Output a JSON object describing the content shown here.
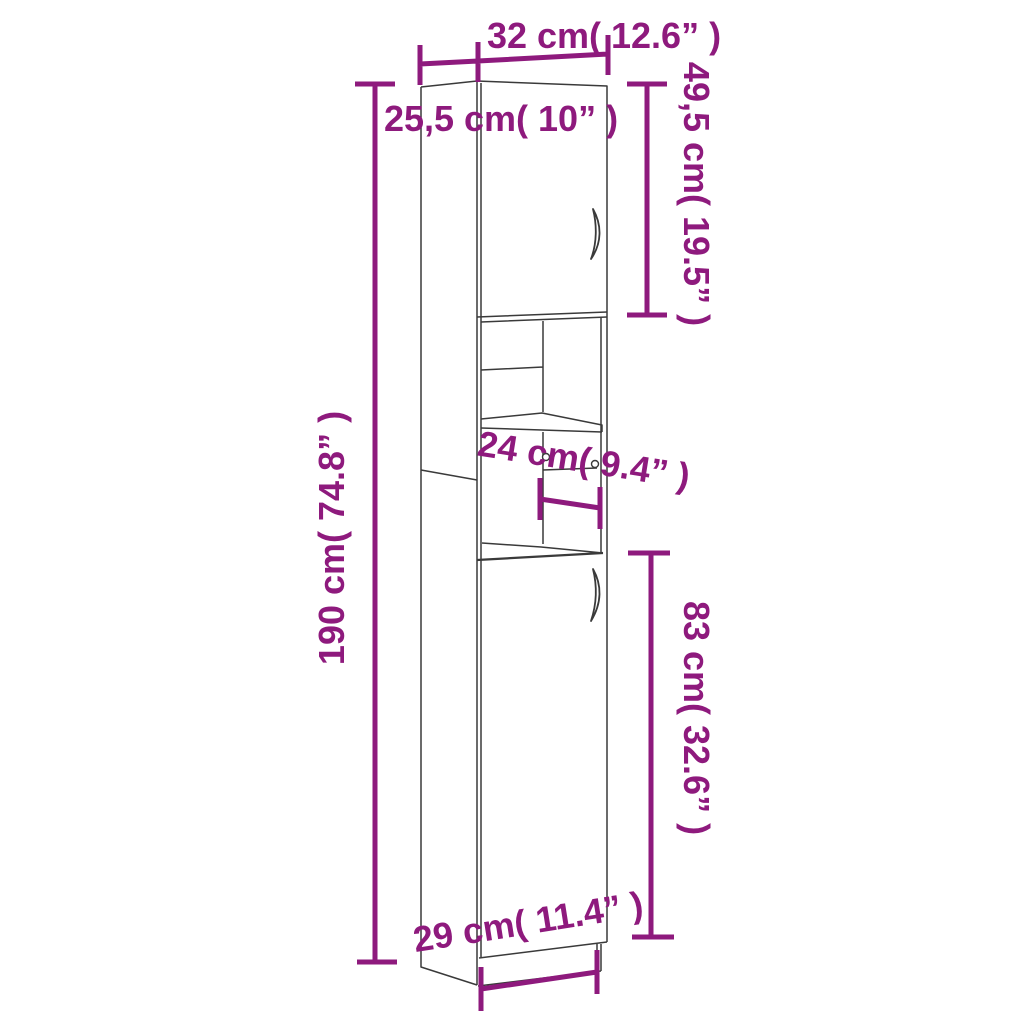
{
  "colors": {
    "background": "#ffffff",
    "accent": "#8e1a7d",
    "drawing_line": "#3a3a3a"
  },
  "labels": {
    "top_width": "32 cm( 12.6” )",
    "depth": "25,5 cm( 10” )",
    "upper_door_height": "49,5 cm( 19.5” )",
    "total_height": "190 cm( 74.8” )",
    "shelf_depth": "24 cm( 9.4” )",
    "lower_door_height": "83 cm( 32.6” )",
    "bottom_width": "29 cm( 11.4” )"
  }
}
